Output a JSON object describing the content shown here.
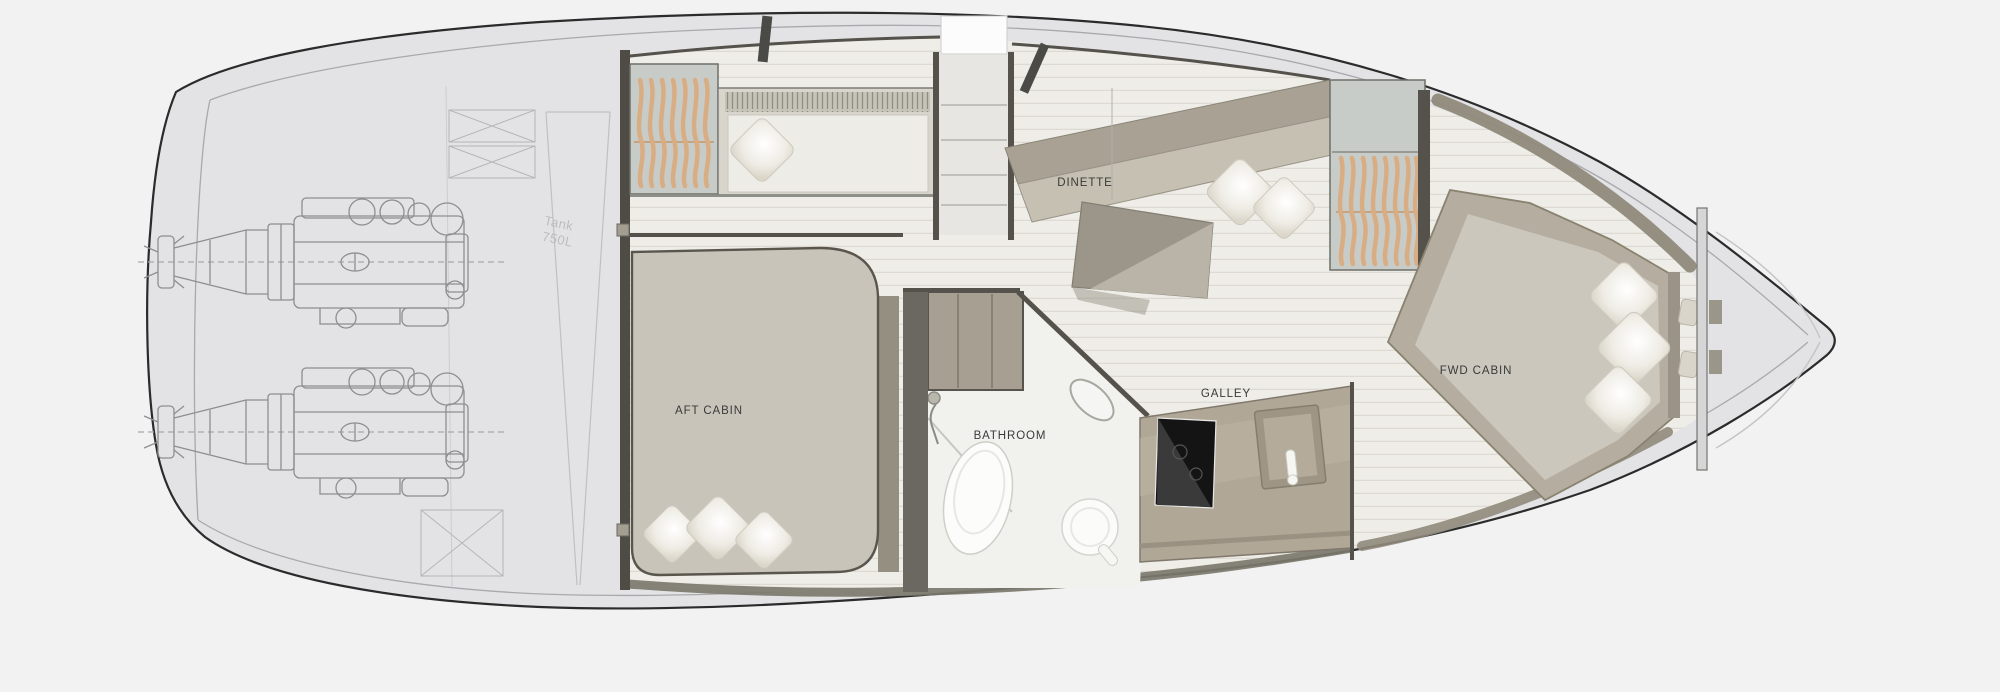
{
  "diagram": {
    "type": "yacht-interior-floor-plan",
    "labels": {
      "dinette": "DINETTE",
      "aft_cabin": "AFT CABIN",
      "bathroom": "BATHROOM",
      "galley": "GALLEY",
      "fwd_cabin": "FWD CABIN",
      "tank_line1": "Tank",
      "tank_line2": "750L"
    },
    "colors": {
      "background": "#f2f2f3",
      "hull_fill": "#e3e3e5",
      "hull_stroke": "#2b2b2b",
      "wall_dark": "#55524c",
      "floor": "#eeede8",
      "floor_stripe": "#dcdad2",
      "bed_taupe": "#c9c4b9",
      "bench_taupe": "#a8a194",
      "counter_taupe": "#b0a797",
      "wardrobe_fill": "#c8ccc8",
      "hanger_tan": "#d8ad84",
      "pillow_white": "#f5f3ee",
      "cooktop_black": "#141414",
      "engine_line": "#8e8e90",
      "tank_text": "#bdbdbf",
      "label_text": "#3a3a3a"
    }
  }
}
